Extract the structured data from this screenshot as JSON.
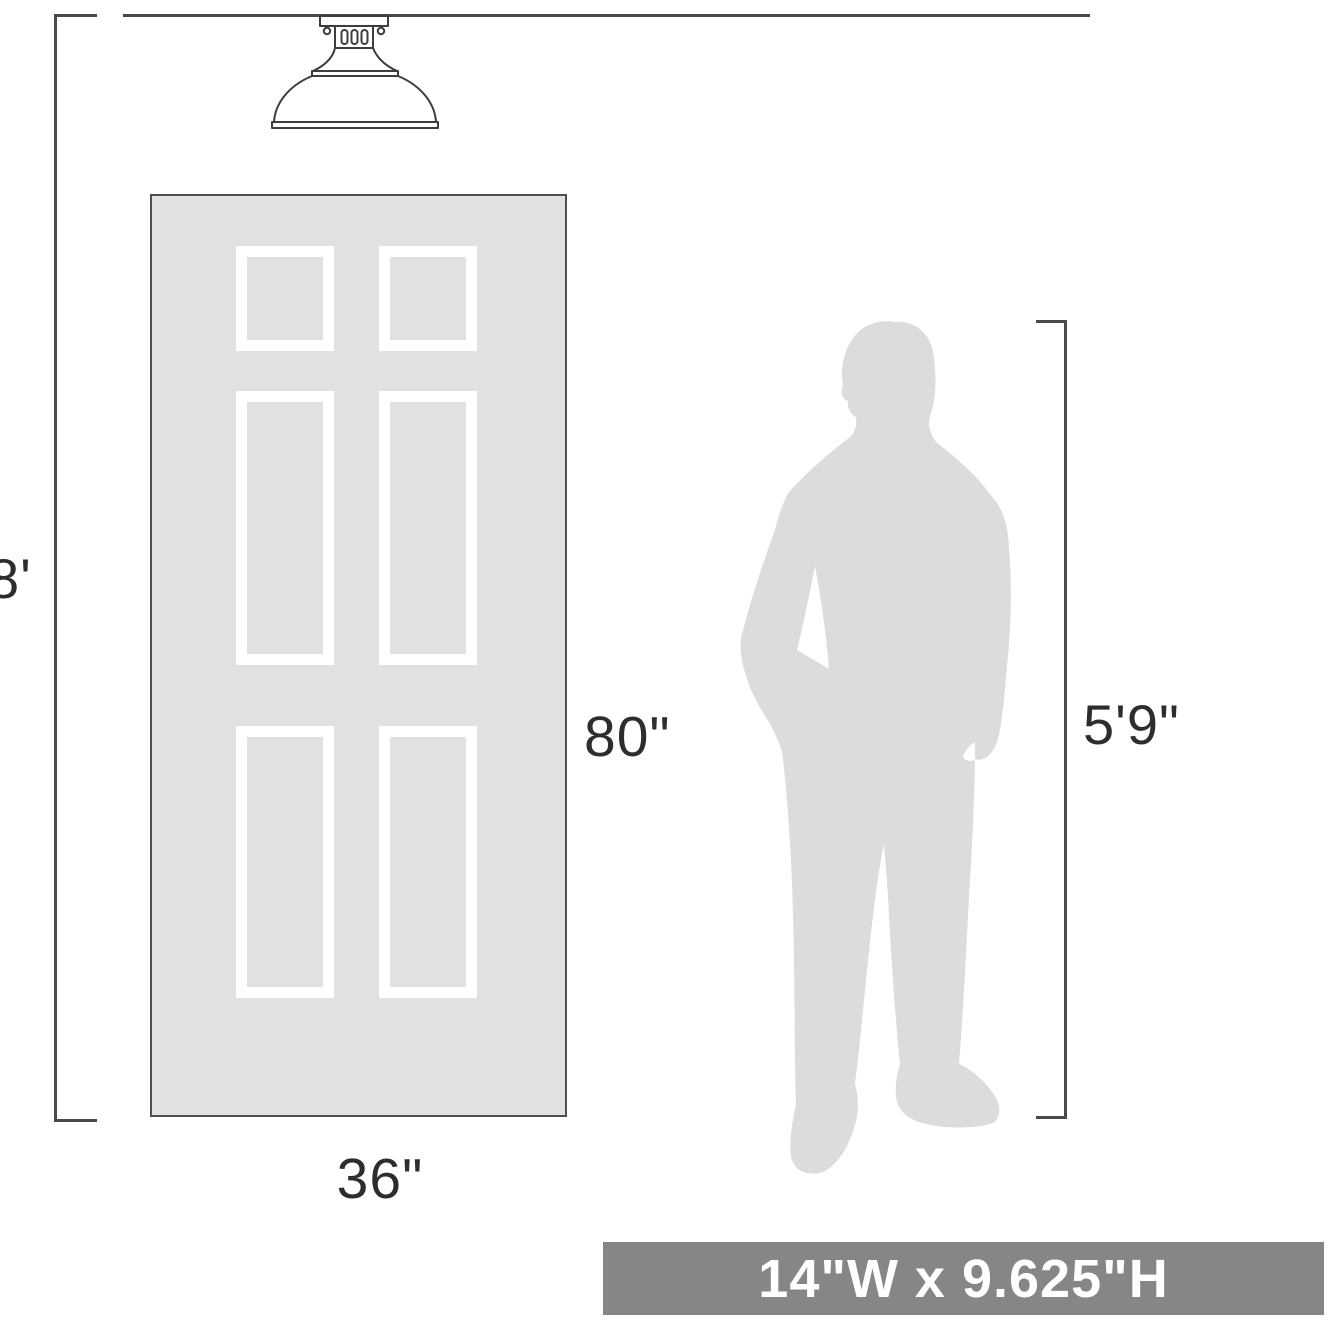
{
  "diagram": {
    "ceiling_height_label": "8'",
    "door": {
      "height_label": "80\"",
      "width_label": "36\""
    },
    "person": {
      "height_label": "5'9\""
    },
    "banner_text": "14\"W x 9.625\"H",
    "colors": {
      "line": "#4a4a4a",
      "text": "#2d2d2d",
      "door_fill": "#e1e1e1",
      "door_border": "#4f4f4f",
      "panel_frame": "#ffffff",
      "silhouette_fill": "#dcdcdc",
      "fixture_stroke": "#3d3d3d",
      "banner_background": "#868686",
      "banner_text": "#ffffff"
    }
  }
}
